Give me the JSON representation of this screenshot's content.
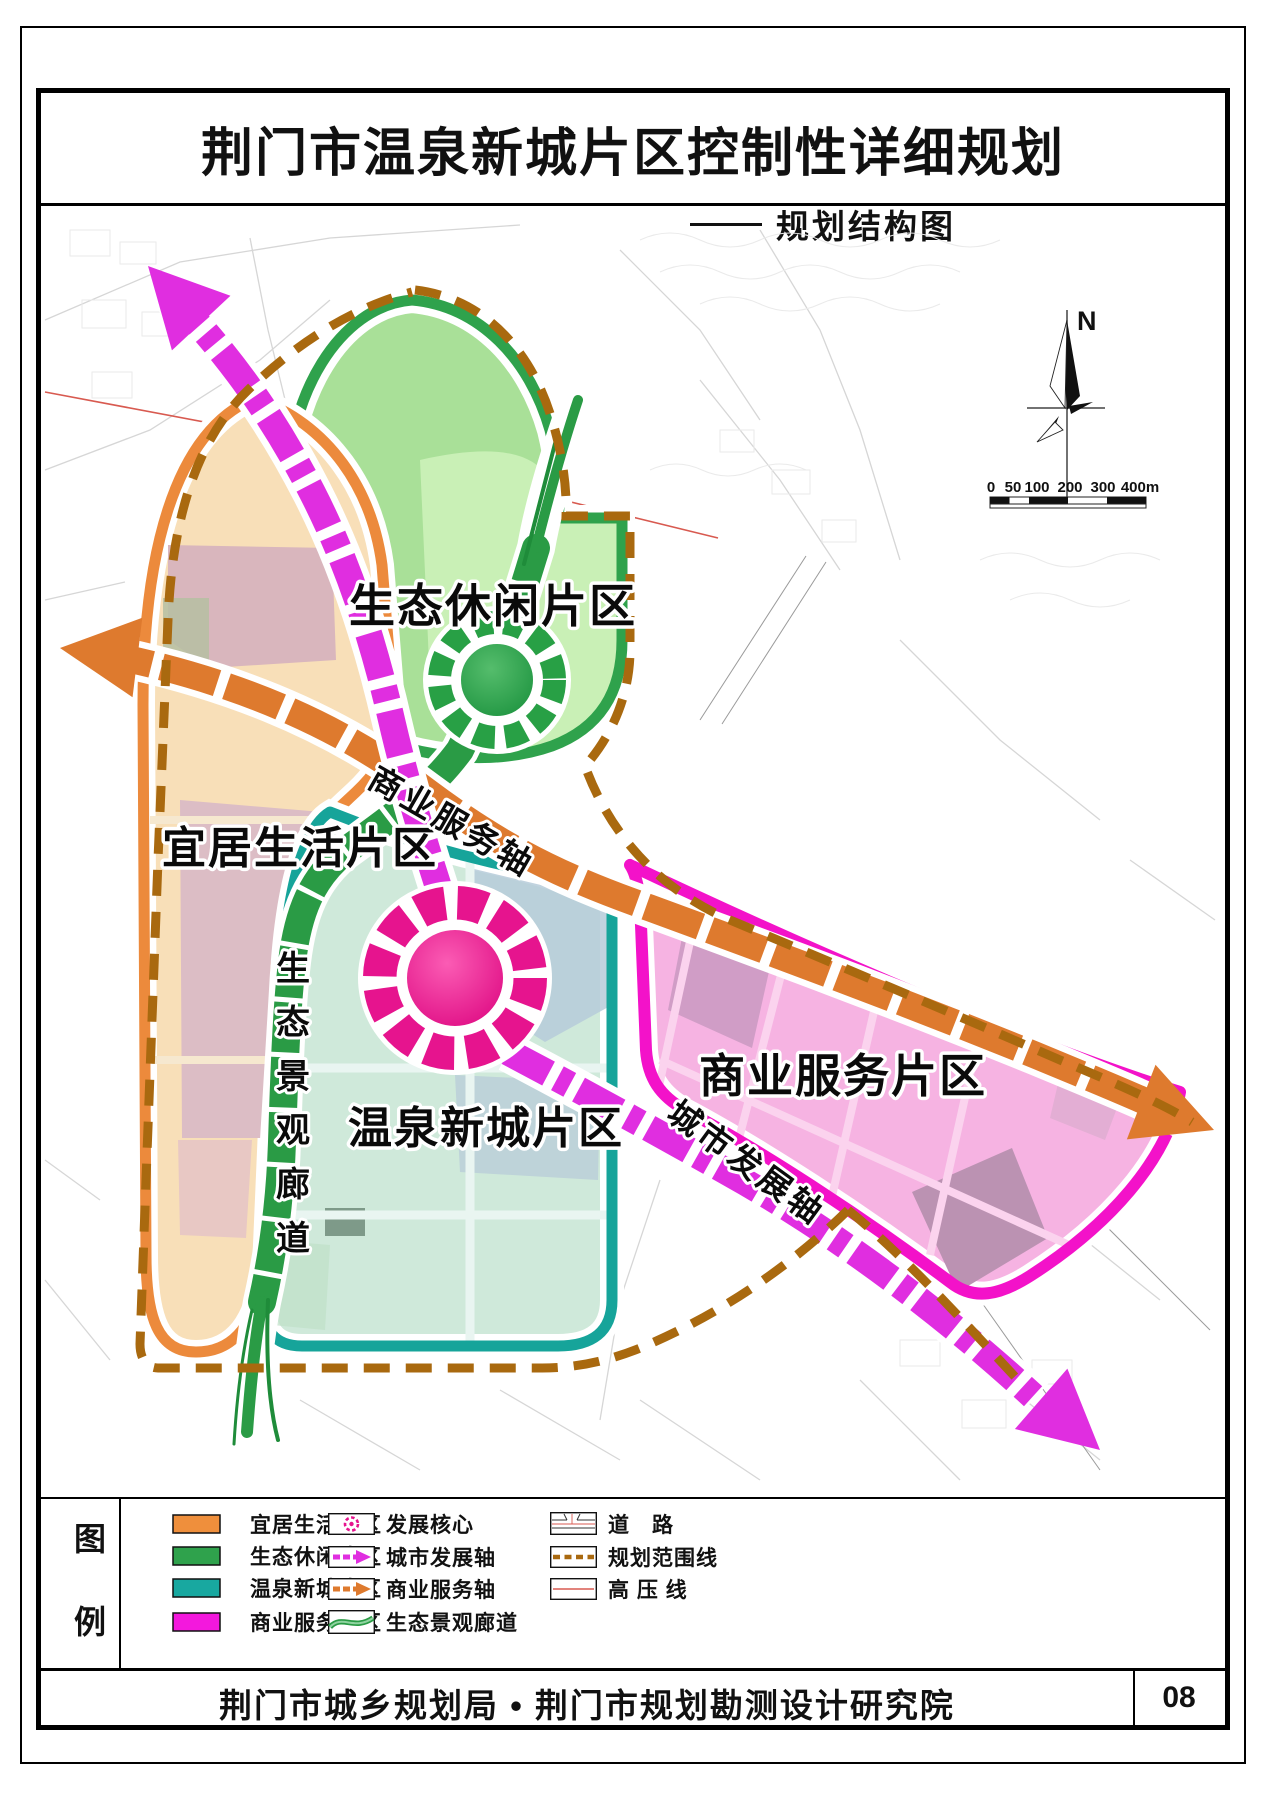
{
  "header": {
    "title": "荆门市温泉新城片区控制性详细规划",
    "subtitle": "规划结构图"
  },
  "map": {
    "north_label": "N",
    "scale_labels": [
      "0",
      "50",
      "100",
      "200",
      "300",
      "400m"
    ],
    "zones": {
      "livable": {
        "label": "宜居生活片区",
        "fill": "#f8dfb8",
        "border": "#ec8a3c"
      },
      "eco": {
        "label": "生态休闲片区",
        "fill": "#a9e098",
        "border": "#2fa24c"
      },
      "hotspring": {
        "label": "温泉新城片区",
        "fill": "#cfe9da",
        "border": "#16a49a"
      },
      "commercial": {
        "label": "商业服务片区",
        "fill": "#f6b3e2",
        "border": "#f312c9"
      }
    },
    "axes": {
      "development": {
        "label": "城市发展轴",
        "color": "#e02ee0"
      },
      "commercial": {
        "label": "商业服务轴",
        "color": "#de7a2e"
      }
    },
    "corridor": {
      "label": "生态景观廊道",
      "chars": [
        "生",
        "态",
        "景",
        "观",
        "廊",
        "道"
      ],
      "color": "#2a9b45"
    },
    "boundary_color": "#a9690f",
    "core_colors": {
      "development": "#e6148e",
      "eco": "#28a045"
    },
    "hv_color": "#d85a50"
  },
  "legend": {
    "title_chars": [
      "图",
      "例"
    ],
    "zone_items": [
      {
        "label": "宜居生活片区",
        "color": "#ef8f3c"
      },
      {
        "label": "生态休闲片区",
        "color": "#2fa24c"
      },
      {
        "label": "温泉新城片区",
        "color": "#18a8a0"
      },
      {
        "label": "商业服务片区",
        "color": "#f318dd"
      }
    ],
    "symbol_items": [
      {
        "label": "发展核心",
        "color": "#e6148e"
      },
      {
        "label": "城市发展轴",
        "color": "#e02ee0"
      },
      {
        "label": "商业服务轴",
        "color": "#de7a2e"
      },
      {
        "label": "生态景观廊道",
        "color": "#2a9b45"
      }
    ],
    "line_items": [
      {
        "label": "道　路",
        "color": "#d85a50"
      },
      {
        "label": "规划范围线",
        "color": "#a9690f"
      },
      {
        "label": "高 压 线",
        "color": "#d85a50"
      }
    ]
  },
  "footer": {
    "org": "荆门市城乡规划局 • 荆门市规划勘测设计研究院",
    "page_number": "08"
  }
}
